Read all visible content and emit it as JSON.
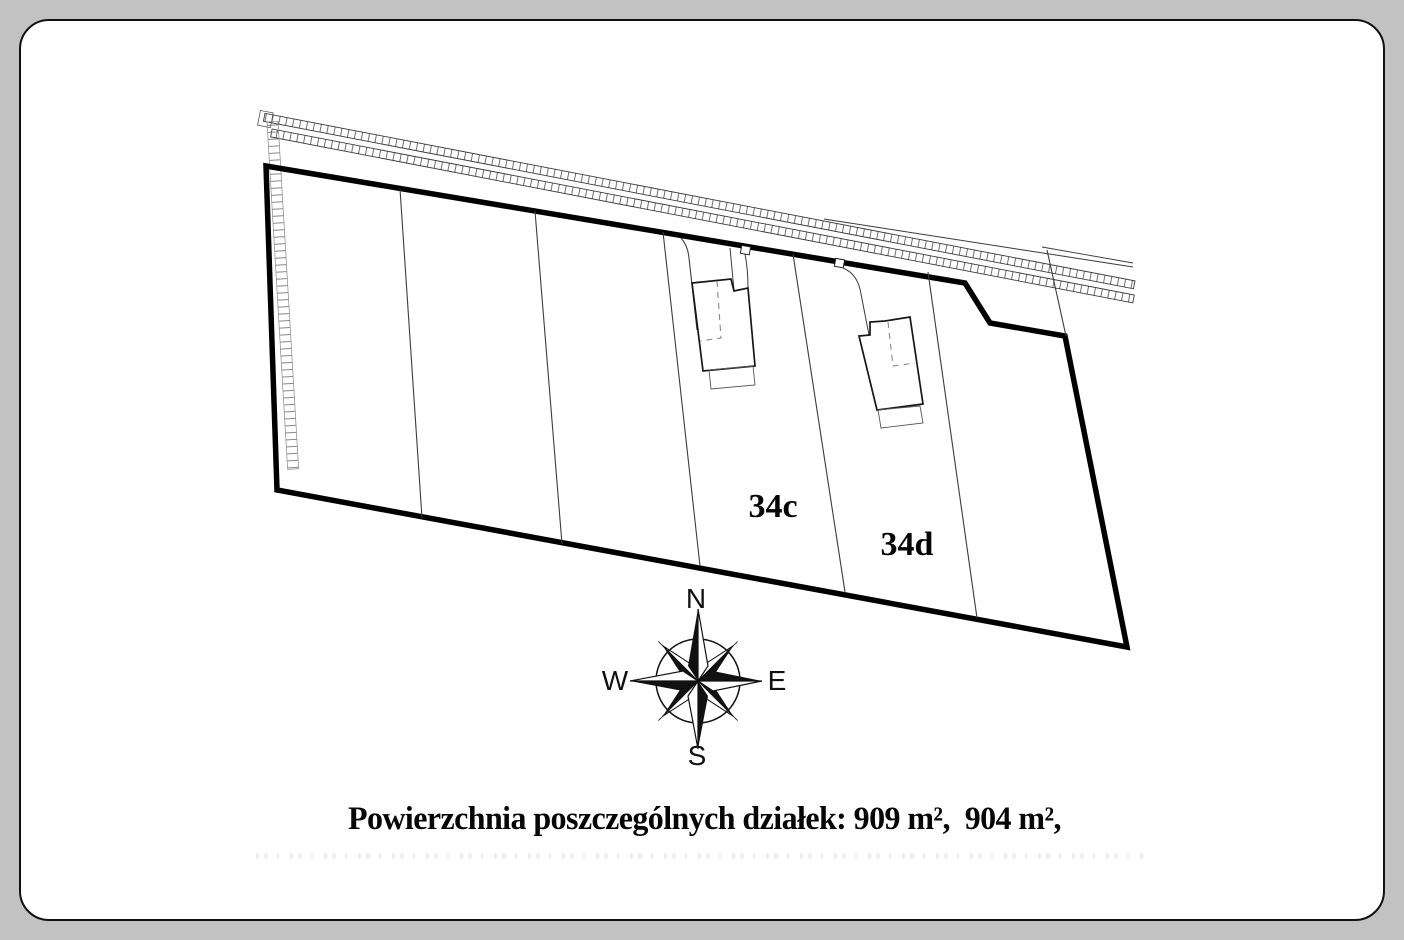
{
  "plan": {
    "plots": [
      {
        "label": "34c",
        "area": "909 m²"
      },
      {
        "label": "34d",
        "area": "904 m²"
      }
    ],
    "caption": "Powierzchnia poszczególnych działek: 909 m²,  904 m²,",
    "compass": {
      "north": "N",
      "south": "S",
      "east": "E",
      "west": "W"
    },
    "colors": {
      "page_background": "#c2c2c2",
      "paper": "#ffffff",
      "boundary_line": "#000000",
      "thin_line": "#3c3c3c",
      "dashed_line": "#8a8a8a"
    }
  }
}
